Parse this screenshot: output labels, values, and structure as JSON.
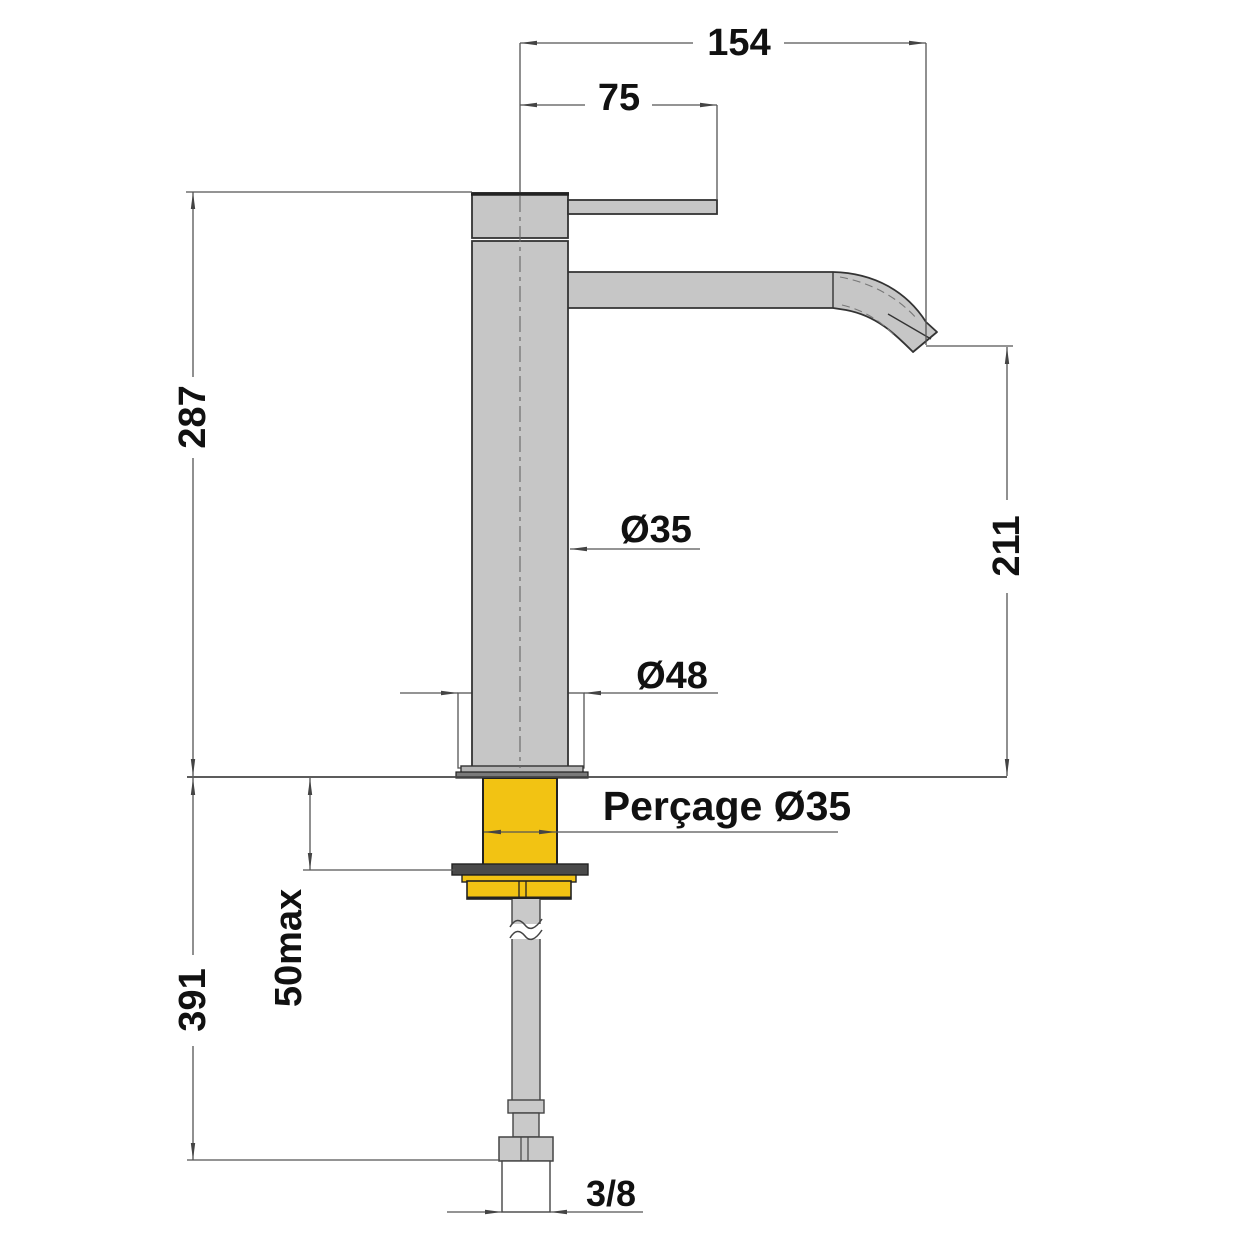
{
  "drawing": {
    "type": "technical-dimension-drawing",
    "subject": "basin mixer tap side elevation with installation dimensions",
    "labels": {
      "total_reach": "154",
      "handle_offset": "75",
      "height_above_deck": "287",
      "spout_outlet_height": "211",
      "body_diameter": "Ø35",
      "base_diameter": "Ø48",
      "drill_hole": "Perçage Ø35",
      "deck_thickness_max": "50max",
      "below_deck_length": "391",
      "supply_connection": "3/8"
    },
    "colors": {
      "body_fill": "#c6c6c6",
      "brass_fill": "#f2c313",
      "washer_fill": "#4a4a4a",
      "outline": "#333333",
      "dimension_lines": "#555555",
      "text": "#111111",
      "background": "#ffffff"
    }
  }
}
